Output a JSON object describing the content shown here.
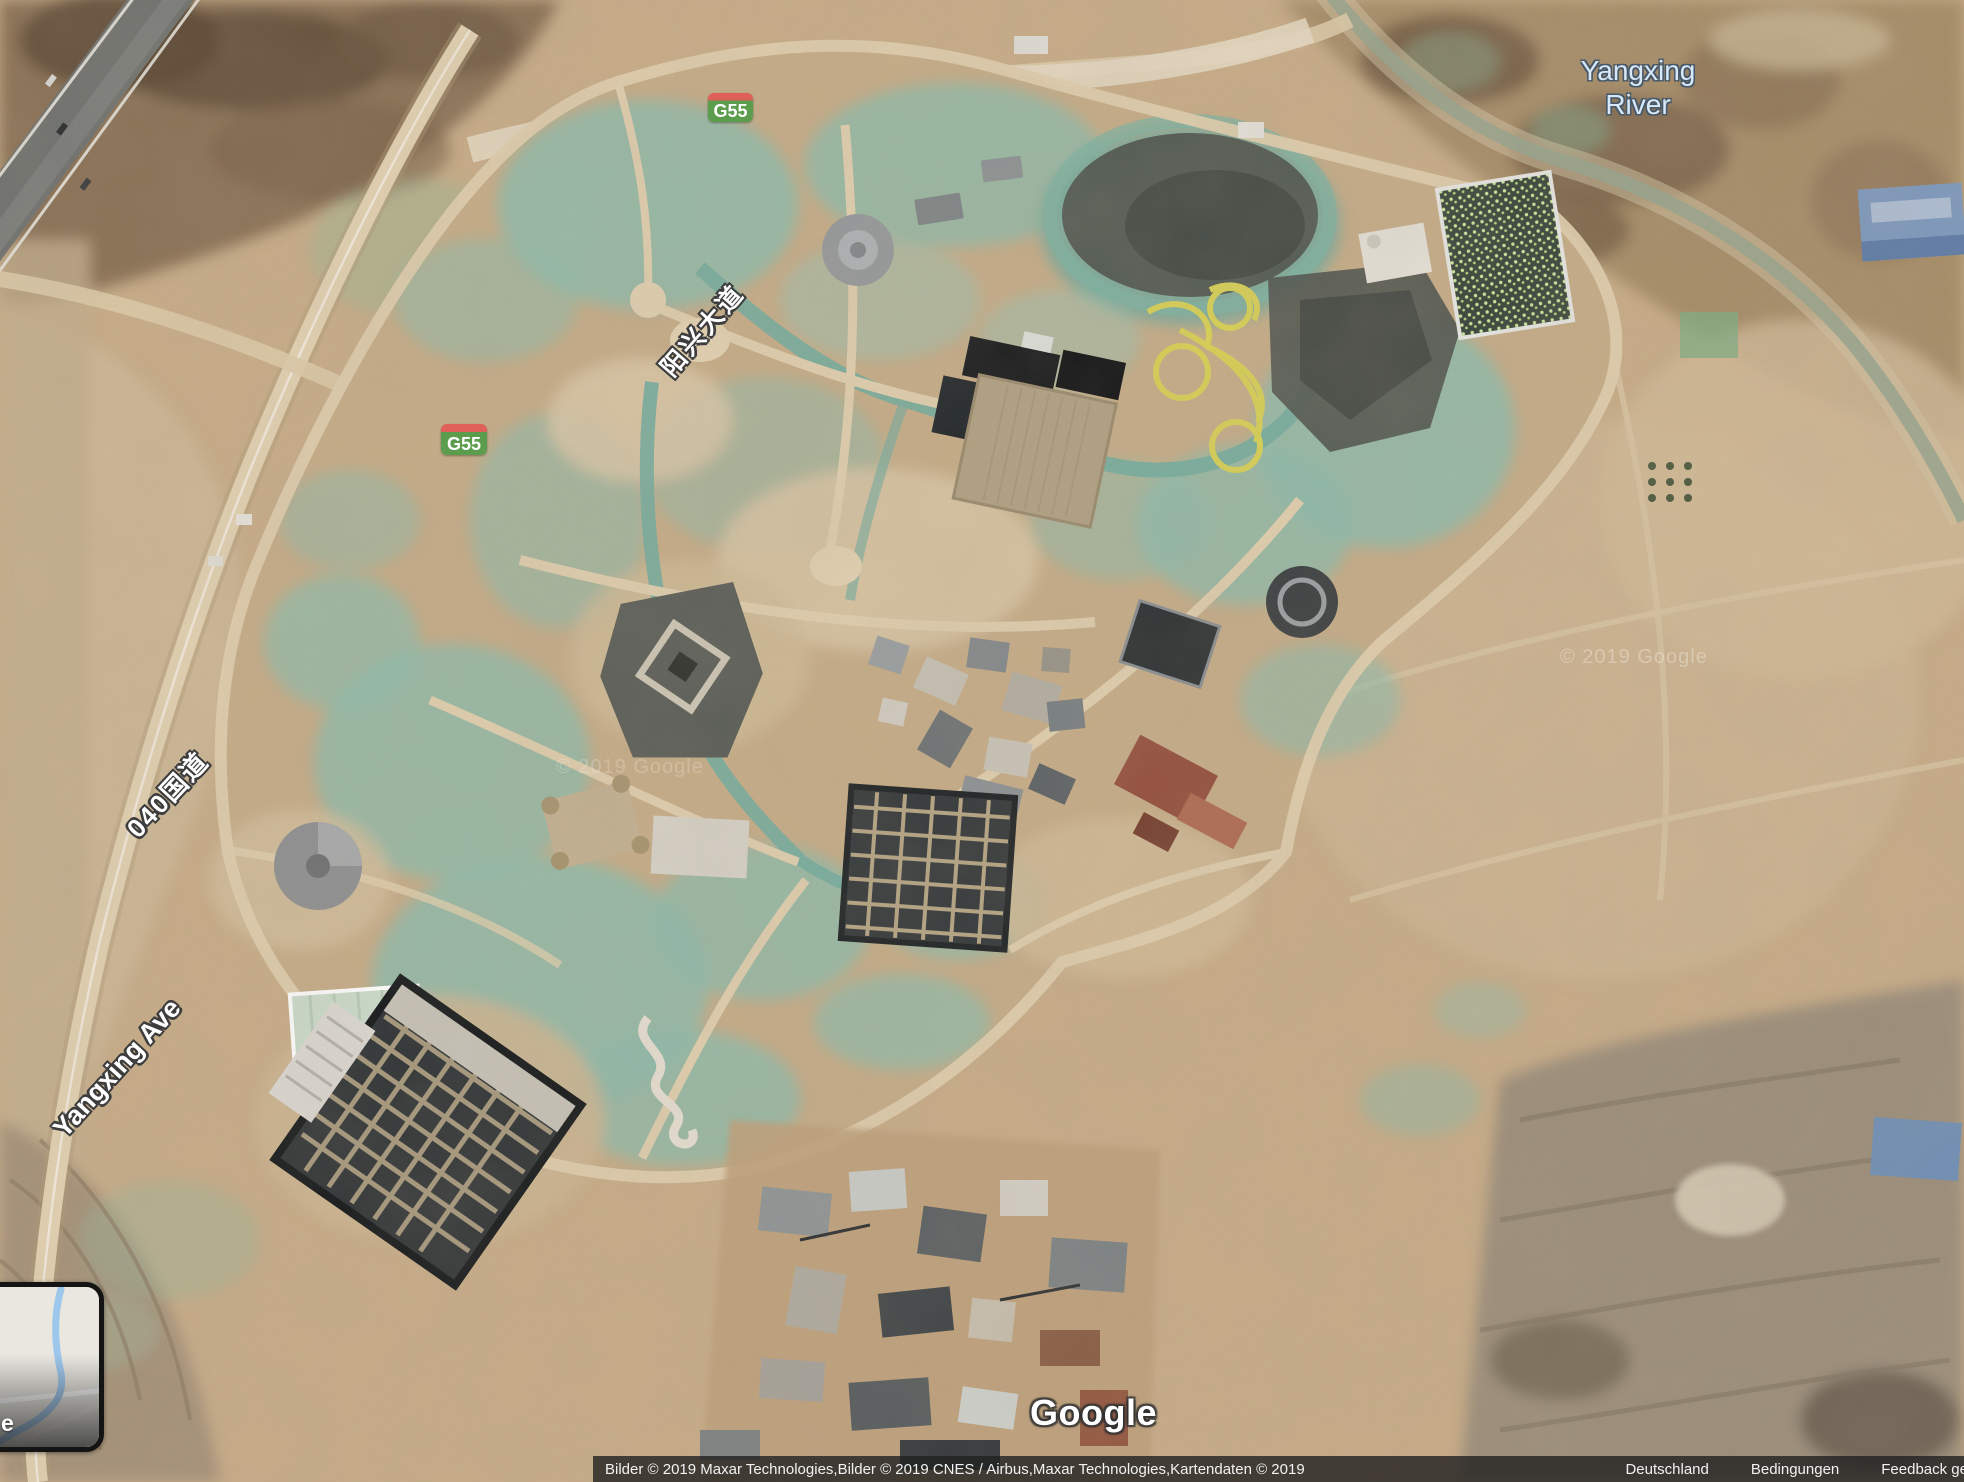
{
  "map_labels": {
    "river_line1": "Yangxing",
    "river_line2": "River",
    "road_cn_avenue": "阳兴大道",
    "road_cn_national": "040国道",
    "road_en_avenue": "Yangxing Ave",
    "shields": [
      {
        "label": "G55"
      },
      {
        "label": "G55"
      }
    ],
    "watermark": "© 2019 Google"
  },
  "branding": {
    "logo": "Google"
  },
  "attribution": {
    "imagery_credit": "Bilder © 2019 Maxar Technologies,Bilder © 2019 CNES / Airbus,Maxar Technologies,Kartendaten © 2019",
    "region": "Deutschland",
    "terms": "Bedingungen",
    "feedback": "Feedback ge"
  },
  "inset_toggle": {
    "visible_label": "e"
  },
  "colors": {
    "shield_green": "#5b9c4d",
    "shield_red": "#df5f59",
    "terrain_tan": "#c9ad88",
    "mesh_teal": "#8fbcab",
    "river_label_blue": "#d8e8f6",
    "attribution_bg": "rgba(33,33,33,0.8)"
  }
}
